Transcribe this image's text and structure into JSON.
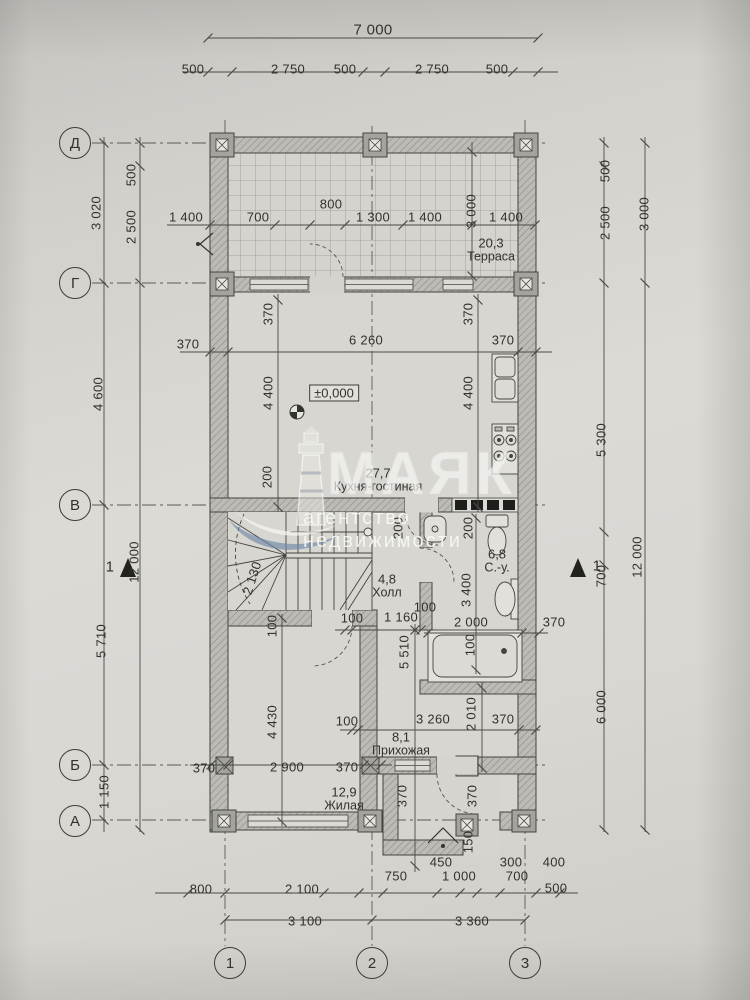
{
  "watermark": {
    "brand": "МАЯК",
    "subtitle": "агентство недвижимости",
    "accent_color": "#6d88a7"
  },
  "paper_color": "#d9d7d2",
  "ink_color": "#34342f",
  "level_mark": {
    "t": "±0,000"
  },
  "axes": {
    "rows": [
      {
        "label": "Д",
        "x": 75,
        "y": 143
      },
      {
        "label": "Г",
        "x": 75,
        "y": 283
      },
      {
        "label": "В",
        "x": 75,
        "y": 505
      },
      {
        "label": "Б",
        "x": 75,
        "y": 765
      },
      {
        "label": "А",
        "x": 75,
        "y": 821
      }
    ],
    "cols": [
      {
        "label": "1",
        "x": 230,
        "y": 963
      },
      {
        "label": "2",
        "x": 372,
        "y": 963
      },
      {
        "label": "3",
        "x": 525,
        "y": 963
      }
    ]
  },
  "rooms": [
    {
      "area": "20,3",
      "name": "Терраса",
      "x": 491,
      "y": 250
    },
    {
      "area": "27,7",
      "name": "Кухня-гостиная",
      "x": 378,
      "y": 480
    },
    {
      "area": "4,8",
      "name": "Холл",
      "x": 387,
      "y": 586
    },
    {
      "area": "6,8",
      "name": "С.-у.",
      "x": 497,
      "y": 561
    },
    {
      "area": "8,1",
      "name": "Прихожая",
      "x": 401,
      "y": 744
    },
    {
      "area": "12,9",
      "name": "Жилая",
      "x": 344,
      "y": 799
    }
  ],
  "labels": [
    {
      "t": "7 000",
      "x": 373,
      "y": 30,
      "fs": 15
    },
    {
      "t": "500",
      "x": 193,
      "y": 69
    },
    {
      "t": "2 750",
      "x": 288,
      "y": 69
    },
    {
      "t": "500",
      "x": 345,
      "y": 69
    },
    {
      "t": "2 750",
      "x": 432,
      "y": 69
    },
    {
      "t": "500",
      "x": 497,
      "y": 69
    },
    {
      "t": "3 020",
      "x": 96,
      "y": 213,
      "r": -90
    },
    {
      "t": "500",
      "x": 131,
      "y": 175,
      "r": -90
    },
    {
      "t": "2 500",
      "x": 131,
      "y": 227,
      "r": -90
    },
    {
      "t": "4 600",
      "x": 98,
      "y": 394,
      "r": -90
    },
    {
      "t": "12 000",
      "x": 134,
      "y": 562,
      "r": -90
    },
    {
      "t": "5 710",
      "x": 101,
      "y": 641,
      "r": -90
    },
    {
      "t": "1 150",
      "x": 104,
      "y": 792,
      "r": -90
    },
    {
      "t": "500",
      "x": 605,
      "y": 171,
      "r": -90
    },
    {
      "t": "2 500",
      "x": 605,
      "y": 223,
      "r": -90
    },
    {
      "t": "3 000",
      "x": 644,
      "y": 214,
      "r": -90
    },
    {
      "t": "5 300",
      "x": 601,
      "y": 440,
      "r": -90
    },
    {
      "t": "700",
      "x": 601,
      "y": 576,
      "r": -90
    },
    {
      "t": "6 000",
      "x": 601,
      "y": 707,
      "r": -90
    },
    {
      "t": "12 000",
      "x": 637,
      "y": 557,
      "r": -90
    },
    {
      "t": "1",
      "x": 110,
      "y": 567,
      "fs": 15,
      "n": "section-mark-label"
    },
    {
      "t": "1",
      "x": 597,
      "y": 566,
      "fs": 15,
      "n": "section-mark-label"
    },
    {
      "t": "1 400",
      "x": 186,
      "y": 217
    },
    {
      "t": "700",
      "x": 258,
      "y": 217
    },
    {
      "t": "800",
      "x": 331,
      "y": 204
    },
    {
      "t": "1 300",
      "x": 373,
      "y": 217
    },
    {
      "t": "1 400",
      "x": 425,
      "y": 217
    },
    {
      "t": "3 000",
      "x": 471,
      "y": 211,
      "r": -90
    },
    {
      "t": "1 400",
      "x": 506,
      "y": 217
    },
    {
      "t": "370",
      "x": 188,
      "y": 344
    },
    {
      "t": "6 260",
      "x": 366,
      "y": 340
    },
    {
      "t": "370",
      "x": 503,
      "y": 340
    },
    {
      "t": "370",
      "x": 268,
      "y": 314,
      "r": -90
    },
    {
      "t": "370",
      "x": 468,
      "y": 314,
      "r": -90
    },
    {
      "t": "4 400",
      "x": 268,
      "y": 393,
      "r": -90
    },
    {
      "t": "4 400",
      "x": 468,
      "y": 393,
      "r": -90
    },
    {
      "t": "200",
      "x": 267,
      "y": 477,
      "r": -90
    },
    {
      "t": "2 130",
      "x": 252,
      "y": 578,
      "r": -72
    },
    {
      "t": "200",
      "x": 398,
      "y": 528,
      "r": -90
    },
    {
      "t": "200",
      "x": 468,
      "y": 528,
      "r": -90
    },
    {
      "t": "3 400",
      "x": 466,
      "y": 590,
      "r": -90
    },
    {
      "t": "100",
      "x": 425,
      "y": 607
    },
    {
      "t": "100",
      "x": 272,
      "y": 626,
      "r": -90
    },
    {
      "t": "100",
      "x": 352,
      "y": 618
    },
    {
      "t": "1 160",
      "x": 401,
      "y": 617
    },
    {
      "t": "5 510",
      "x": 404,
      "y": 652,
      "r": -90
    },
    {
      "t": "2 000",
      "x": 471,
      "y": 622
    },
    {
      "t": "370",
      "x": 554,
      "y": 622
    },
    {
      "t": "100",
      "x": 470,
      "y": 645,
      "r": -90
    },
    {
      "t": "4 430",
      "x": 272,
      "y": 722,
      "r": -90
    },
    {
      "t": "100",
      "x": 347,
      "y": 721
    },
    {
      "t": "3 260",
      "x": 433,
      "y": 719
    },
    {
      "t": "2 010",
      "x": 471,
      "y": 714,
      "r": -90
    },
    {
      "t": "370",
      "x": 503,
      "y": 719
    },
    {
      "t": "370",
      "x": 204,
      "y": 768
    },
    {
      "t": "2 900",
      "x": 287,
      "y": 767
    },
    {
      "t": "370",
      "x": 347,
      "y": 767
    },
    {
      "t": "370",
      "x": 402,
      "y": 796,
      "r": -90
    },
    {
      "t": "370",
      "x": 472,
      "y": 796,
      "r": -90
    },
    {
      "t": "150",
      "x": 468,
      "y": 842,
      "r": -90
    },
    {
      "t": "450",
      "x": 441,
      "y": 862
    },
    {
      "t": "300",
      "x": 511,
      "y": 862
    },
    {
      "t": "400",
      "x": 554,
      "y": 862
    },
    {
      "t": "750",
      "x": 396,
      "y": 876
    },
    {
      "t": "1 000",
      "x": 459,
      "y": 876
    },
    {
      "t": "700",
      "x": 517,
      "y": 876
    },
    {
      "t": "800",
      "x": 201,
      "y": 889
    },
    {
      "t": "2 100",
      "x": 302,
      "y": 889
    },
    {
      "t": "500",
      "x": 556,
      "y": 888
    },
    {
      "t": "3 100",
      "x": 305,
      "y": 921
    },
    {
      "t": "3 360",
      "x": 472,
      "y": 921
    }
  ],
  "dim_lines": [
    {
      "o": "h",
      "p": 38,
      "a": 208,
      "b": 538,
      "t": [
        208,
        538
      ]
    },
    {
      "o": "h",
      "p": 72,
      "a": 183,
      "b": 558,
      "t": [
        208,
        232,
        363,
        385,
        513,
        538
      ]
    },
    {
      "o": "v",
      "p": 104,
      "a": 137,
      "b": 832,
      "t": [
        143,
        283,
        505,
        765,
        820
      ]
    },
    {
      "o": "v",
      "p": 140,
      "a": 137,
      "b": 832,
      "t": [
        143,
        166,
        283,
        830
      ]
    },
    {
      "o": "v",
      "p": 604,
      "a": 137,
      "b": 832,
      "t": [
        143,
        166,
        283,
        532,
        565,
        830
      ]
    },
    {
      "o": "v",
      "p": 645,
      "a": 137,
      "b": 832,
      "t": [
        143,
        283,
        830
      ]
    },
    {
      "o": "h",
      "p": 225,
      "a": 167,
      "b": 535,
      "t": [
        210,
        275,
        310,
        345,
        403,
        472,
        535
      ]
    },
    {
      "o": "h",
      "p": 352,
      "a": 180,
      "b": 552,
      "t": [
        210,
        228,
        518,
        536
      ]
    },
    {
      "o": "h",
      "p": 630,
      "a": 335,
      "b": 438,
      "t": [
        345,
        352,
        415,
        421
      ]
    },
    {
      "o": "h",
      "p": 633,
      "a": 424,
      "b": 548,
      "t": [
        428,
        522,
        539
      ]
    },
    {
      "o": "h",
      "p": 730,
      "a": 340,
      "b": 540,
      "t": [
        352,
        358,
        519,
        536
      ]
    },
    {
      "o": "h",
      "p": 765,
      "a": 190,
      "b": 392,
      "t": [
        211,
        228,
        364,
        381
      ]
    },
    {
      "o": "h",
      "p": 893,
      "a": 155,
      "b": 578,
      "t": [
        188,
        225,
        324,
        359,
        383,
        437,
        460,
        477,
        500,
        536,
        560
      ]
    },
    {
      "o": "h",
      "p": 920,
      "a": 225,
      "b": 525,
      "t": [
        225,
        372,
        525
      ]
    },
    {
      "o": "v",
      "p": 282,
      "a": 614,
      "b": 826,
      "t": [
        618,
        822
      ]
    },
    {
      "o": "v",
      "p": 415,
      "a": 624,
      "b": 872,
      "t": [
        630,
        866
      ]
    },
    {
      "o": "v",
      "p": 482,
      "a": 682,
      "b": 772,
      "t": [
        688,
        768
      ]
    },
    {
      "o": "v",
      "p": 476,
      "a": 514,
      "b": 674,
      "t": [
        518,
        670
      ]
    },
    {
      "o": "v",
      "p": 472,
      "a": 142,
      "b": 278,
      "t": [
        152,
        276
      ]
    },
    {
      "o": "v",
      "p": 278,
      "a": 294,
      "b": 512,
      "t": [
        300,
        507
      ]
    },
    {
      "o": "v",
      "p": 478,
      "a": 294,
      "b": 512,
      "t": [
        300,
        507
      ]
    }
  ]
}
